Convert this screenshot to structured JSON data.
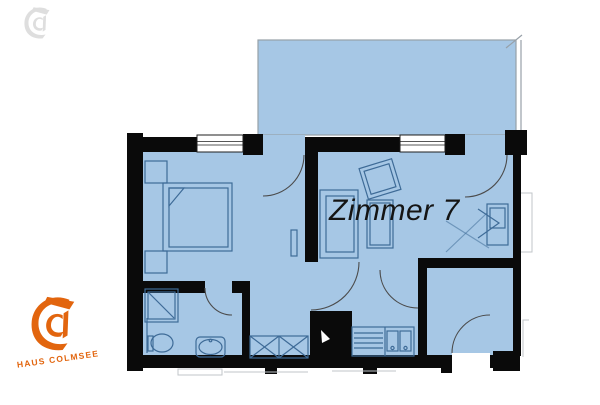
{
  "plan": {
    "room_label": "Zimmer 7",
    "features": [
      "balcony",
      "bedroom",
      "living-room",
      "bathroom",
      "hallway",
      "kitchenette",
      "entrance"
    ],
    "furniture_icons": [
      "bed-icon",
      "nightstand-icon",
      "sofa-icon",
      "table-icon",
      "tv-icon",
      "wardrobe-icon",
      "shower-icon",
      "toilet-icon",
      "washbasin-icon",
      "kitchen-sink-icon",
      "radiator-icon",
      "door-swing-icon",
      "window-icon"
    ]
  },
  "watermark": {
    "logo_text": "HAUS COLMSEE",
    "logo_icon": "blackletter-c-icon"
  },
  "colors": {
    "room_fill": "#a6c7e5",
    "wall": "#0a0a0a",
    "furniture_line": "#3e6b97",
    "balcony_border": "#97a0a8",
    "brand_orange": "#e2650e",
    "label_text": "#141414",
    "outside_marks": "#c0c5c9",
    "door_line": "#4b4b4b"
  }
}
